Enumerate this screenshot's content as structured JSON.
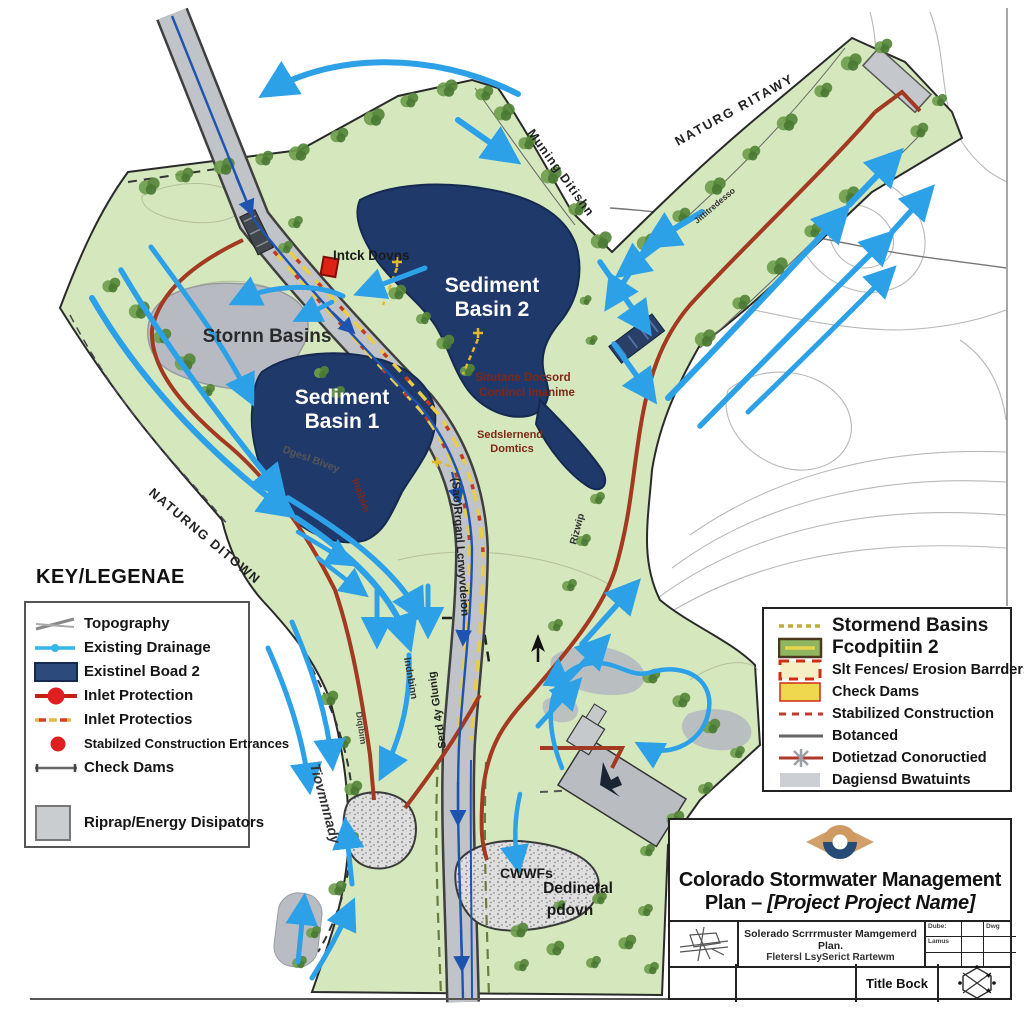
{
  "map": {
    "labels": {
      "intake": "Intck Dovns",
      "basin2_line1": "Sediment",
      "basin2_line2": "Basin 2",
      "basin1_line1": "Sediment",
      "basin1_line2": "Basin 1",
      "storm_basins": "Stornn Basins",
      "note1_line1": "Situtane Docsord",
      "note1_line2": "Contincl Imanime",
      "note2_line1": "Sedslernend",
      "note2_line2": "Domtics",
      "muning_ditishn": "Muning Ditishn",
      "naturg_ritawy": "NATURG RITAWY",
      "naturng_ditown": "NATURNG DITOWN",
      "jittitredesso": "Jittitredesso",
      "dgesl_bivey": "Dgesl Bivey",
      "inaibim": "Inaibim",
      "sao_rrganl": "(Sao)Rrganl Lcrwyvdeion",
      "indnbinn": "Indnbinn",
      "serd_glunig": "Serd 4y Glunig",
      "tiovmnnady": "Tiovmnnady",
      "diqibim": "Diqibim",
      "rizwip": "Rizwip",
      "cwwfs": "CWWFs",
      "dedinetal_line1": "Dedinetal",
      "dedinetal_line2": "pdovn"
    }
  },
  "legend_left": {
    "title": "KEY/LEGENAE",
    "items": [
      {
        "label": "Topography"
      },
      {
        "label": "Existing Drainage"
      },
      {
        "label": "Existinel Boad 2"
      },
      {
        "label": "Inlet Protection"
      },
      {
        "label": "Inlet Protectios"
      },
      {
        "label": "Stabilzed Construction Ertrances"
      },
      {
        "label": "Check Dams"
      },
      {
        "label": "Riprap/Energy Disipators"
      }
    ]
  },
  "legend_right": {
    "items": [
      {
        "label": "Stormend Basins"
      },
      {
        "label": "Fcodpitiin 2"
      },
      {
        "label": "Slt Fences/ Erosion Barrders"
      },
      {
        "label": "Check Dams"
      },
      {
        "label": "Stabilized Construction"
      },
      {
        "label": "Botanced"
      },
      {
        "label": "Dotietzad Conoructied"
      },
      {
        "label": "Dagiensd Bwatuints"
      }
    ]
  },
  "title_block": {
    "title_line1": "Colorado Stormwater Management",
    "title_line2_prefix": "Plan – ",
    "title_line2_project": "[Project Project Name]",
    "subtitle_line1": "Solerado Scrrrmuster Mamgemerd Plan.",
    "subtitle_line2": "Fletersl LsySerict Rartewm",
    "cell_date": "Dube:",
    "cell_status": "Lamus",
    "cell_dwg": "Dwg",
    "title_bock": "Title Bock"
  },
  "colors": {
    "site_green": "#d5e7bd",
    "basin_navy": "#20396b",
    "drainage_blue": "#2da1e8",
    "erosion_red": "#a23920",
    "silt_yellow": "#e3c43c",
    "inlet_red": "#dd2414"
  }
}
